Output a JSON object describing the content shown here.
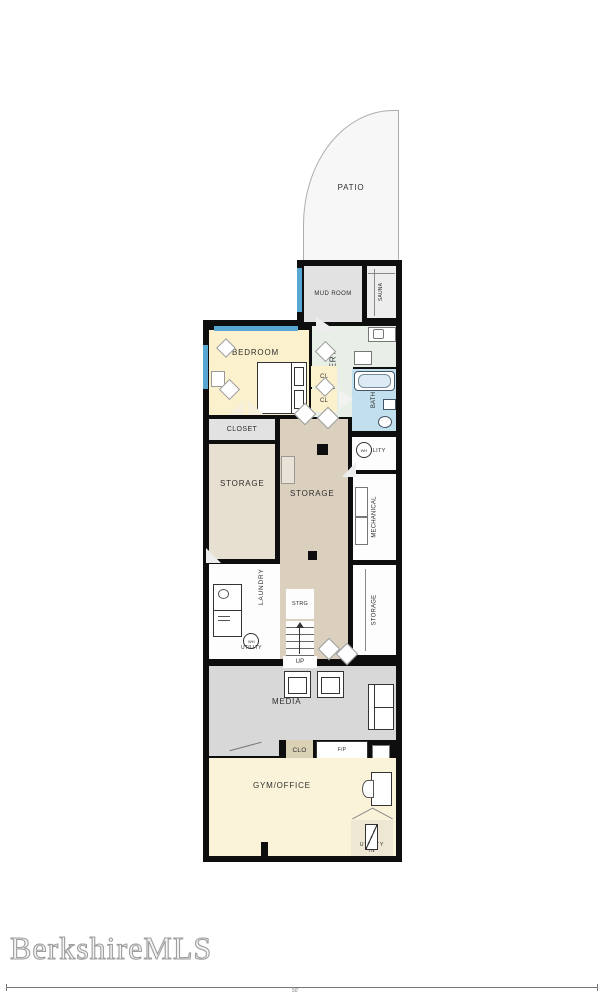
{
  "watermark": {
    "text": "BerkshireMLS"
  },
  "scale_bar": {
    "label": "50'"
  },
  "rooms": {
    "patio": "PATIO",
    "mud_room": "MUD ROOM",
    "sauna": "SAUNA",
    "servery": "SERVERY",
    "bedroom": "BEDROOM",
    "cl_upper": "CL",
    "cl_lower": "CL",
    "bath": "BATH",
    "closet": "CLOSET",
    "utility_upper": "UTILITY",
    "storage_left": "STORAGE",
    "storage_center": "STORAGE",
    "mechanical": "MECHANICAL",
    "storage_right": "STORAGE",
    "laundry": "LAUNDRY",
    "strg": "STRG",
    "stairs_up": "UP",
    "media": "MEDIA",
    "clo": "CLO",
    "fireplace": "F/P",
    "gym_office": "GYM/OFFICE",
    "utility_lower": "UTILITY",
    "utility_lower_in": "IN"
  },
  "icons": {
    "water_heater": "WH"
  },
  "colors": {
    "wall": "#0e0e0e",
    "window": "#57a7d2",
    "bedroom": "#fcf1cd",
    "bath": "#c2dfee",
    "servery": "#e7efe6",
    "storage_center": "#dbd0be",
    "storage_left": "#e7dfd0",
    "media": "#d8d8d8",
    "gym_office": "#faf3da",
    "closet_gray": "#e2e2e2",
    "patio": "#f7f7f7"
  }
}
